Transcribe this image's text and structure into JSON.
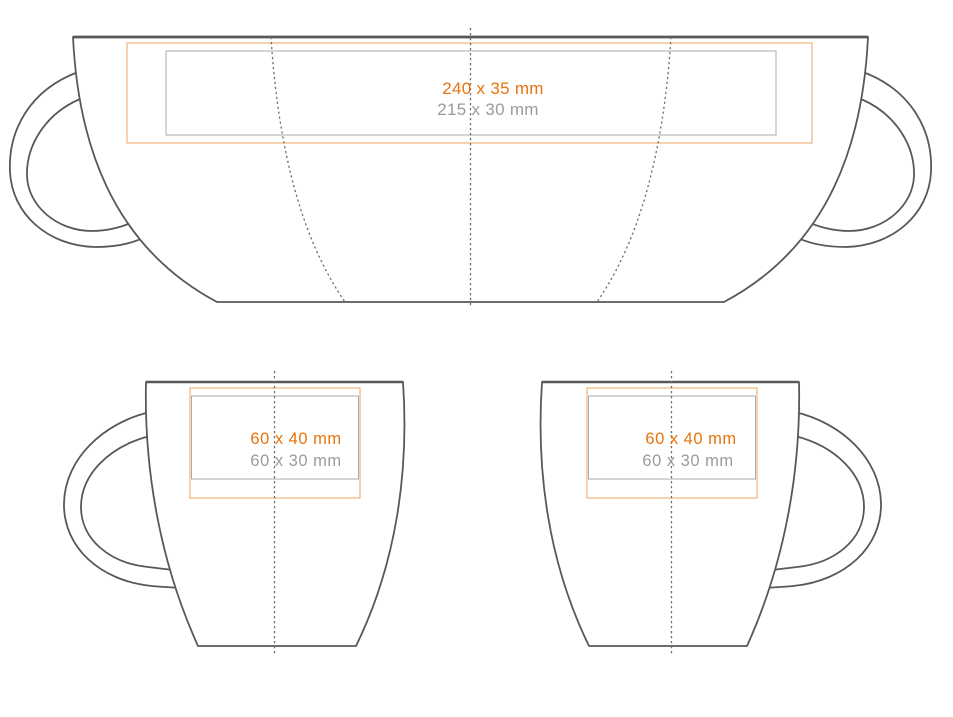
{
  "colors": {
    "outline": "#58585a",
    "guide": "#6e6e6e",
    "print_area_orange": "#f2a35f",
    "print_area_gray": "#ababab",
    "label_orange": "#e8720c",
    "label_gray": "#9b9b9b"
  },
  "views": {
    "wrap": {
      "primary_size": "240 x 35 mm",
      "secondary_size": "215 x 30 mm"
    },
    "front": {
      "primary_size": "60 x 40 mm",
      "secondary_size": "60 x 30 mm"
    },
    "back": {
      "primary_size": "60 x 40 mm",
      "secondary_size": "60 x 30 mm"
    }
  }
}
